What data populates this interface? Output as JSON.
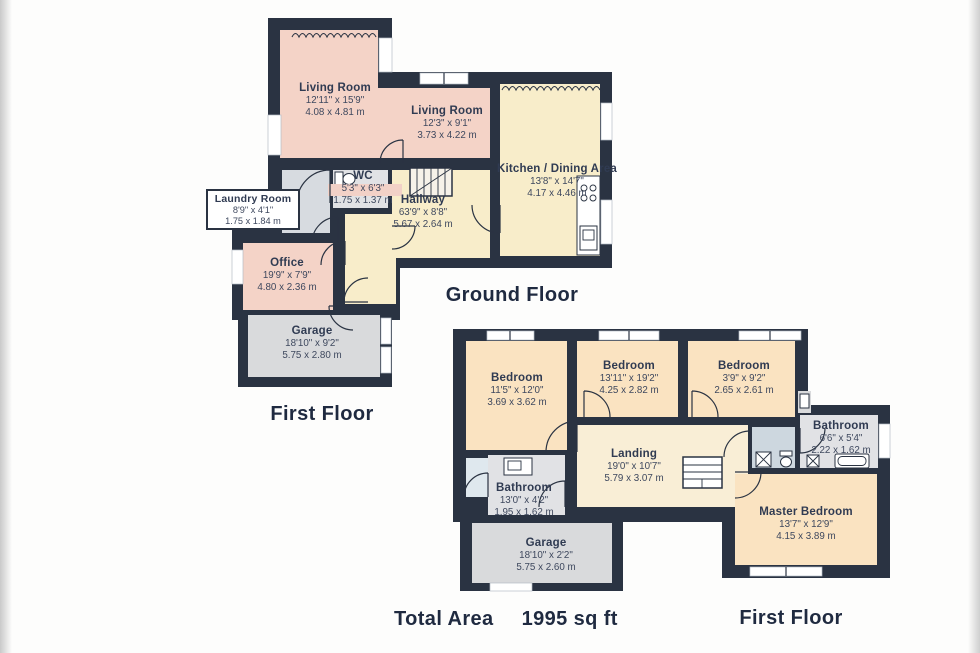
{
  "palette": {
    "wall": "#2a3342",
    "pink": "#f4d3c7",
    "cream": "#f8edca",
    "peach": "#fae3c1",
    "landing": "#f9eed6",
    "gray": "#e1e2e5",
    "garage": "#d9dadc",
    "laundry": "#d7dbe0",
    "lobby": "#cdd7df",
    "closet": "#dfe8ee",
    "text": "#303b52",
    "dim": "#3e485e",
    "title": "#1f2a40",
    "chip": "#f2d1c7"
  },
  "ground_floor": {
    "title": "Ground Floor",
    "secondary_title": "First Floor",
    "rooms": {
      "living_room_1": {
        "name": "Living Room",
        "imperial": "12'11\" x 15'9\"",
        "metric": "4.08 x 4.81 m"
      },
      "living_room_2": {
        "name": "Living Room",
        "imperial": "12'3\" x 9'1\"",
        "metric": "3.73 x 4.22 m"
      },
      "kitchen": {
        "name": "Kitchen / Dining Area",
        "imperial": "13'8\" x 14'7\"",
        "metric": "4.17 x 4.46 m"
      },
      "wc": {
        "name": "WC",
        "imperial": "5'3\" x 6'3\"",
        "metric": "1.75 x 1.37 m"
      },
      "hallway": {
        "name": "Hallway",
        "imperial": "63'9\" x 8'8\"",
        "metric": "5.67 x 2.64 m"
      },
      "laundry": {
        "name": "Laundry Room",
        "imperial": "8'9\" x 4'1\"",
        "metric": "1.75 x 1.84 m"
      },
      "office": {
        "name": "Office",
        "imperial": "19'9\" x 7'9\"",
        "metric": "4.80 x 2.36 m"
      },
      "garage": {
        "name": "Garage",
        "imperial": "18'10\" x 9'2\"",
        "metric": "5.75 x 2.80 m"
      }
    }
  },
  "first_floor": {
    "title": "First Floor",
    "rooms": {
      "bedroom_1": {
        "name": "Bedroom",
        "imperial": "11'5\" x 12'0\"",
        "metric": "3.69 x 3.62 m"
      },
      "bedroom_2": {
        "name": "Bedroom",
        "imperial": "13'11\" x 19'2\"",
        "metric": "4.25 x 2.82 m"
      },
      "bedroom_3": {
        "name": "Bedroom",
        "imperial": "3'9\" x 9'2\"",
        "metric": "2.65 x 2.61 m"
      },
      "bathroom_right": {
        "name": "Bathroom",
        "imperial": "6'6\" x 5'4\"",
        "metric": "2.22 x 1.62 m"
      },
      "landing": {
        "name": "Landing",
        "imperial": "19'0\" x 10'7\"",
        "metric": "5.79 x 3.07 m"
      },
      "bathroom_left": {
        "name": "Bathroom",
        "imperial": "13'0\" x 4'2\"",
        "metric": "1.95 x 1.62 m"
      },
      "garage": {
        "name": "Garage",
        "imperial": "18'10\" x 2'2\"",
        "metric": "5.75 x 2.60 m"
      },
      "master_bedroom": {
        "name": "Master Bedroom",
        "imperial": "13'7\" x 12'9\"",
        "metric": "4.15 x 3.89 m"
      }
    }
  },
  "footer": {
    "total_area_label": "Total Area",
    "total_area_value": "1995 sq ft"
  }
}
